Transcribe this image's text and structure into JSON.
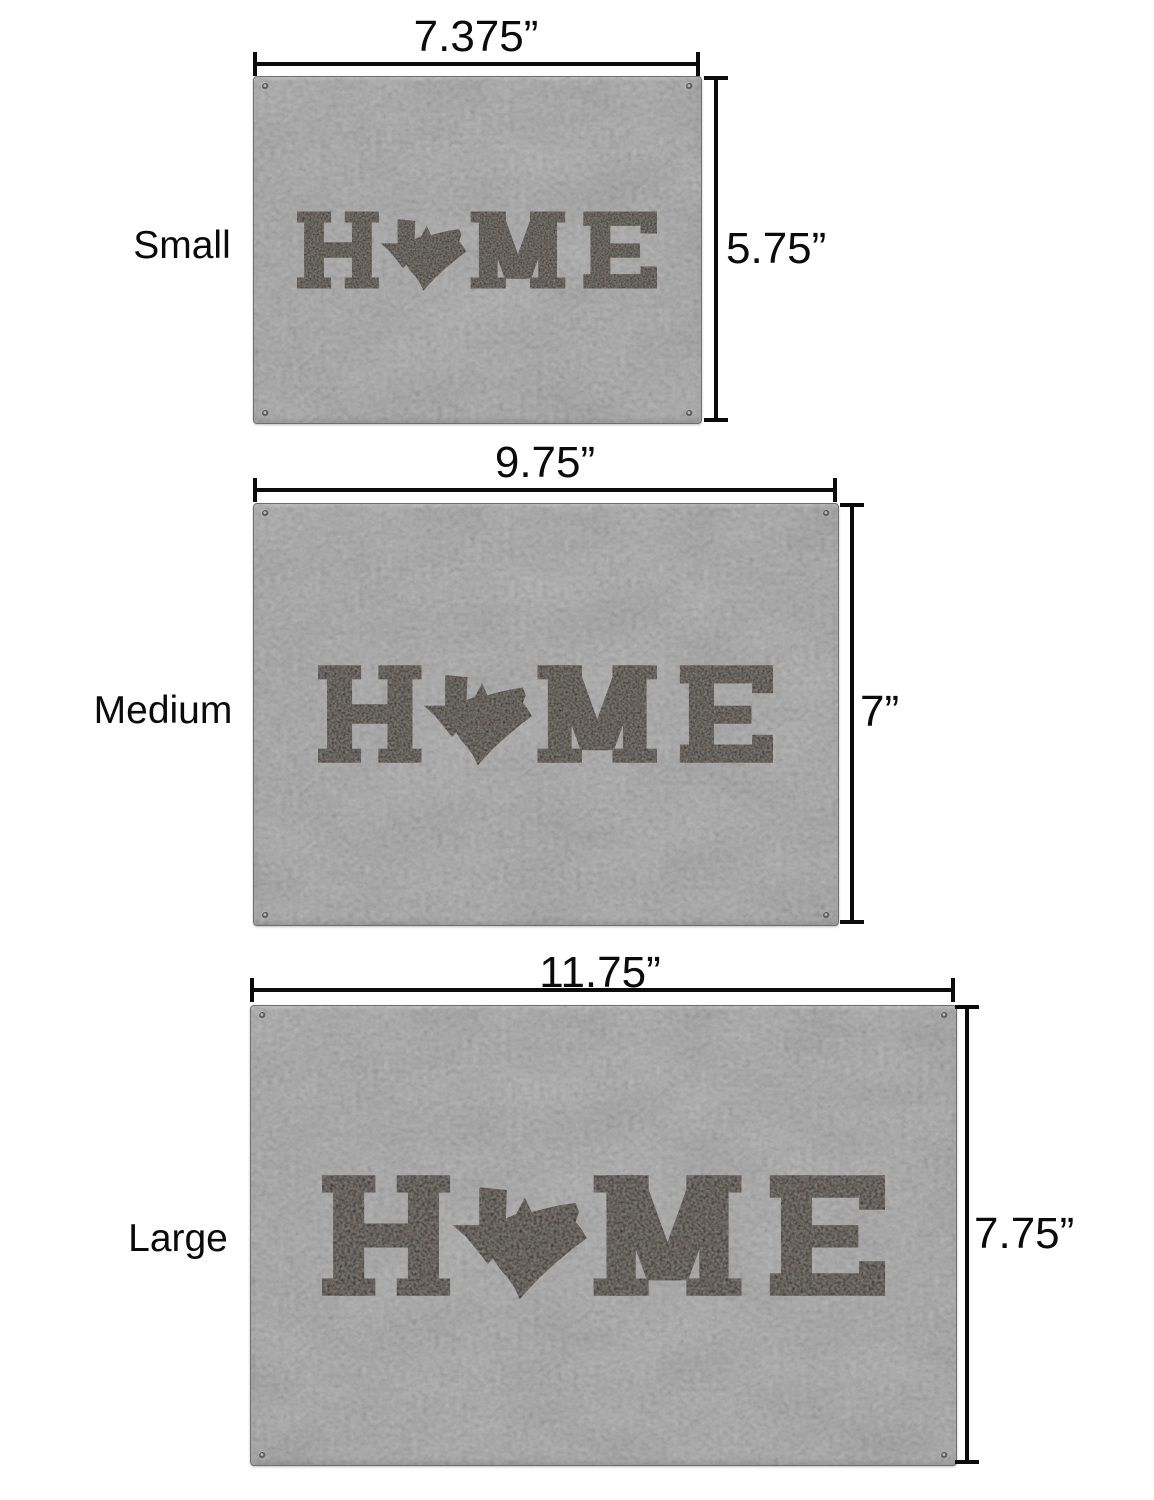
{
  "figure": {
    "kind": "product-size-comparison",
    "background_color": "#ffffff",
    "dimension_line_color": "#0b0b0b"
  },
  "product": {
    "design_word": "HOME",
    "o_replacement": "Texas state silhouette",
    "material": "gray leatherette",
    "plaque_color": "#8e8e8e",
    "engraving_color": "#1b1917"
  },
  "sizes": [
    {
      "name": "Small",
      "width_label": "7.375”",
      "height_label": "5.75”",
      "width_in": 7.375,
      "height_in": 5.75
    },
    {
      "name": "Medium",
      "width_label": "9.75”",
      "height_label": "7”",
      "width_in": 9.75,
      "height_in": 7
    },
    {
      "name": "Large",
      "width_label": "11.75”",
      "height_label": "7.75”",
      "width_in": 11.75,
      "height_in": 7.75
    }
  ]
}
